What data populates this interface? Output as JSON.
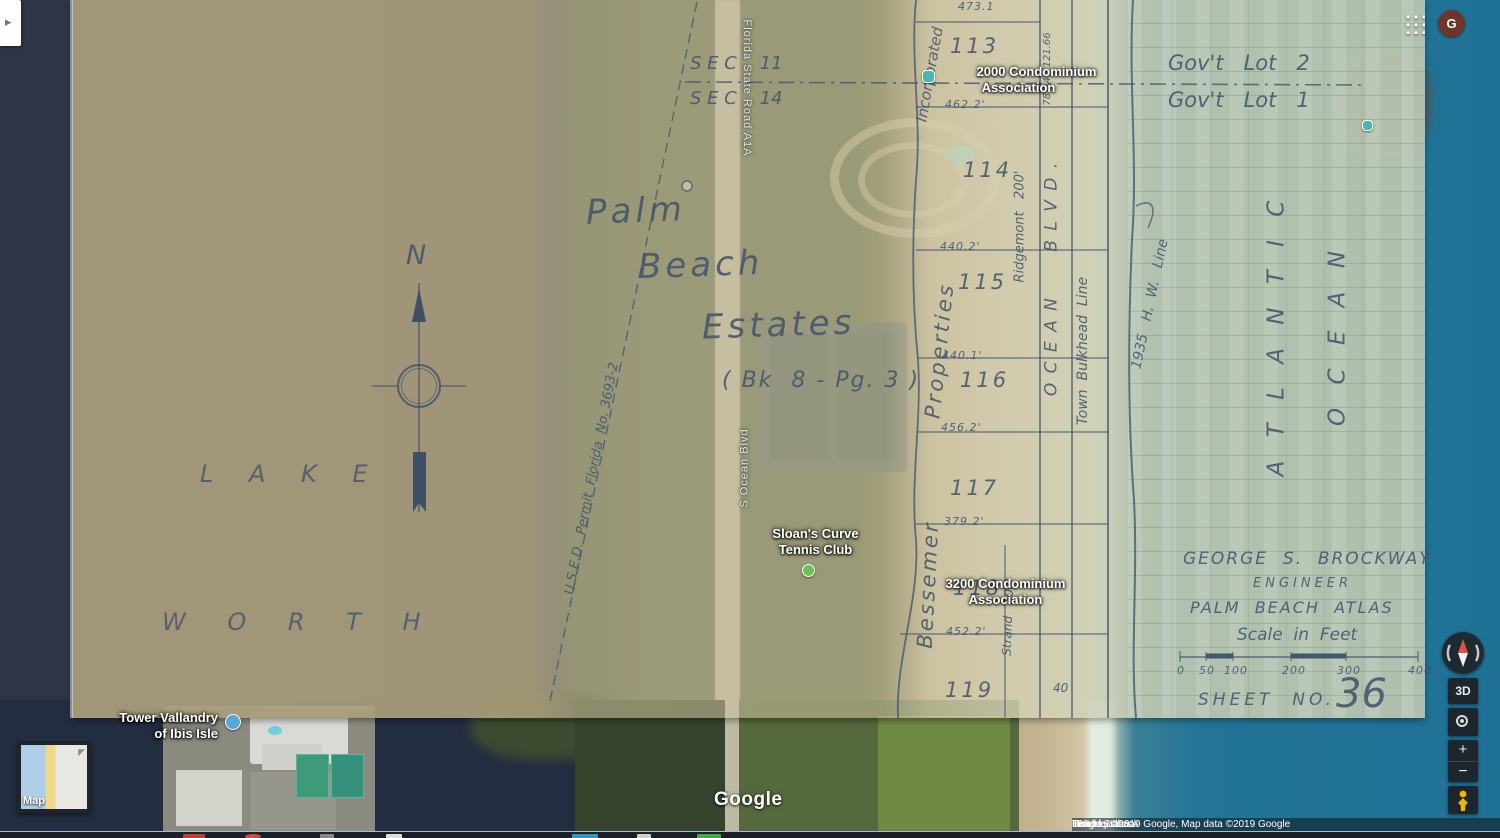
{
  "app": {
    "avatar_initial": "G",
    "side_toggle_arrow": "▸"
  },
  "plat": {
    "sec_top": "S E C    11",
    "sec_bottom": "S E C    14",
    "govt_lot_top": "Gov't   Lot   2",
    "govt_lot_bottom": "Gov't   Lot   1",
    "title_line1": "Palm",
    "title_line2": "Beach",
    "title_line3": "Estates",
    "title_sub": "( Bk  8 - Pg. 3 )",
    "lake": "L A K E",
    "worth": "W O R T H",
    "atlantic": "A T L A N T I C",
    "ocean_word": "O C E A N",
    "ocean_blvd": "O C E A N      B L V D .",
    "ridgemont": "Ridgemont   200'",
    "strand": "Strand   200'",
    "bulkhead": "Town  Bulkhead  Line",
    "hw_line": "1935   H.  W.   Line",
    "properties": "Properties",
    "bessemer": "Bessemer",
    "incorporated": "Incorporated",
    "permit": "U.S.E.D.  Permit  Florida  No. 3693-2",
    "compass_n": "N",
    "top_dim": "473.1",
    "blvd_dims": "78.34   121.66",
    "forty": "40",
    "lots": [
      {
        "num": "113",
        "dim": "462.2'"
      },
      {
        "num": "114",
        "dim": "440.2'"
      },
      {
        "num": "115",
        "dim": "440.1'"
      },
      {
        "num": "116",
        "dim": "456.2'"
      },
      {
        "num": "117",
        "dim": "379.2'"
      },
      {
        "num": "118",
        "dim": "452.2'"
      },
      {
        "num": "119",
        "dim": ""
      }
    ],
    "engineer_name": "GEORGE  S.  BROCKWAY",
    "engineer_title": "ENGINEER",
    "atlas": "PALM  BEACH  ATLAS",
    "scale_caption": "Scale  in  Feet",
    "scale_ticks": [
      "0",
      "50",
      "100",
      "200",
      "300",
      "400"
    ],
    "sheet_label": "SHEET  NO.",
    "sheet_number": "36"
  },
  "map_labels": {
    "condo_2000": [
      "2000 Condominium",
      "Association"
    ],
    "condo_3200": [
      "3200 Condominium",
      "Association"
    ],
    "tennis": [
      "Sloan's Curve",
      "Tennis Club"
    ],
    "tower": [
      "Tower Vallandry",
      "of Ibis Isle"
    ],
    "road_a1a": "Florida State Road A1A",
    "road_ocean": "S Ocean Blvd"
  },
  "controls": {
    "tilt_label": "3D",
    "zoom_in": "+",
    "zoom_out": "−"
  },
  "minimap": {
    "label": "Map",
    "arrow": "◤"
  },
  "watermark": "Google",
  "attribution": {
    "imagery": "Imagery ©2019 Google, Map data ©2019 Google",
    "region": "United States",
    "terms": "Terms",
    "feedback": "Send feedback",
    "scale_text": "100 ft"
  }
}
